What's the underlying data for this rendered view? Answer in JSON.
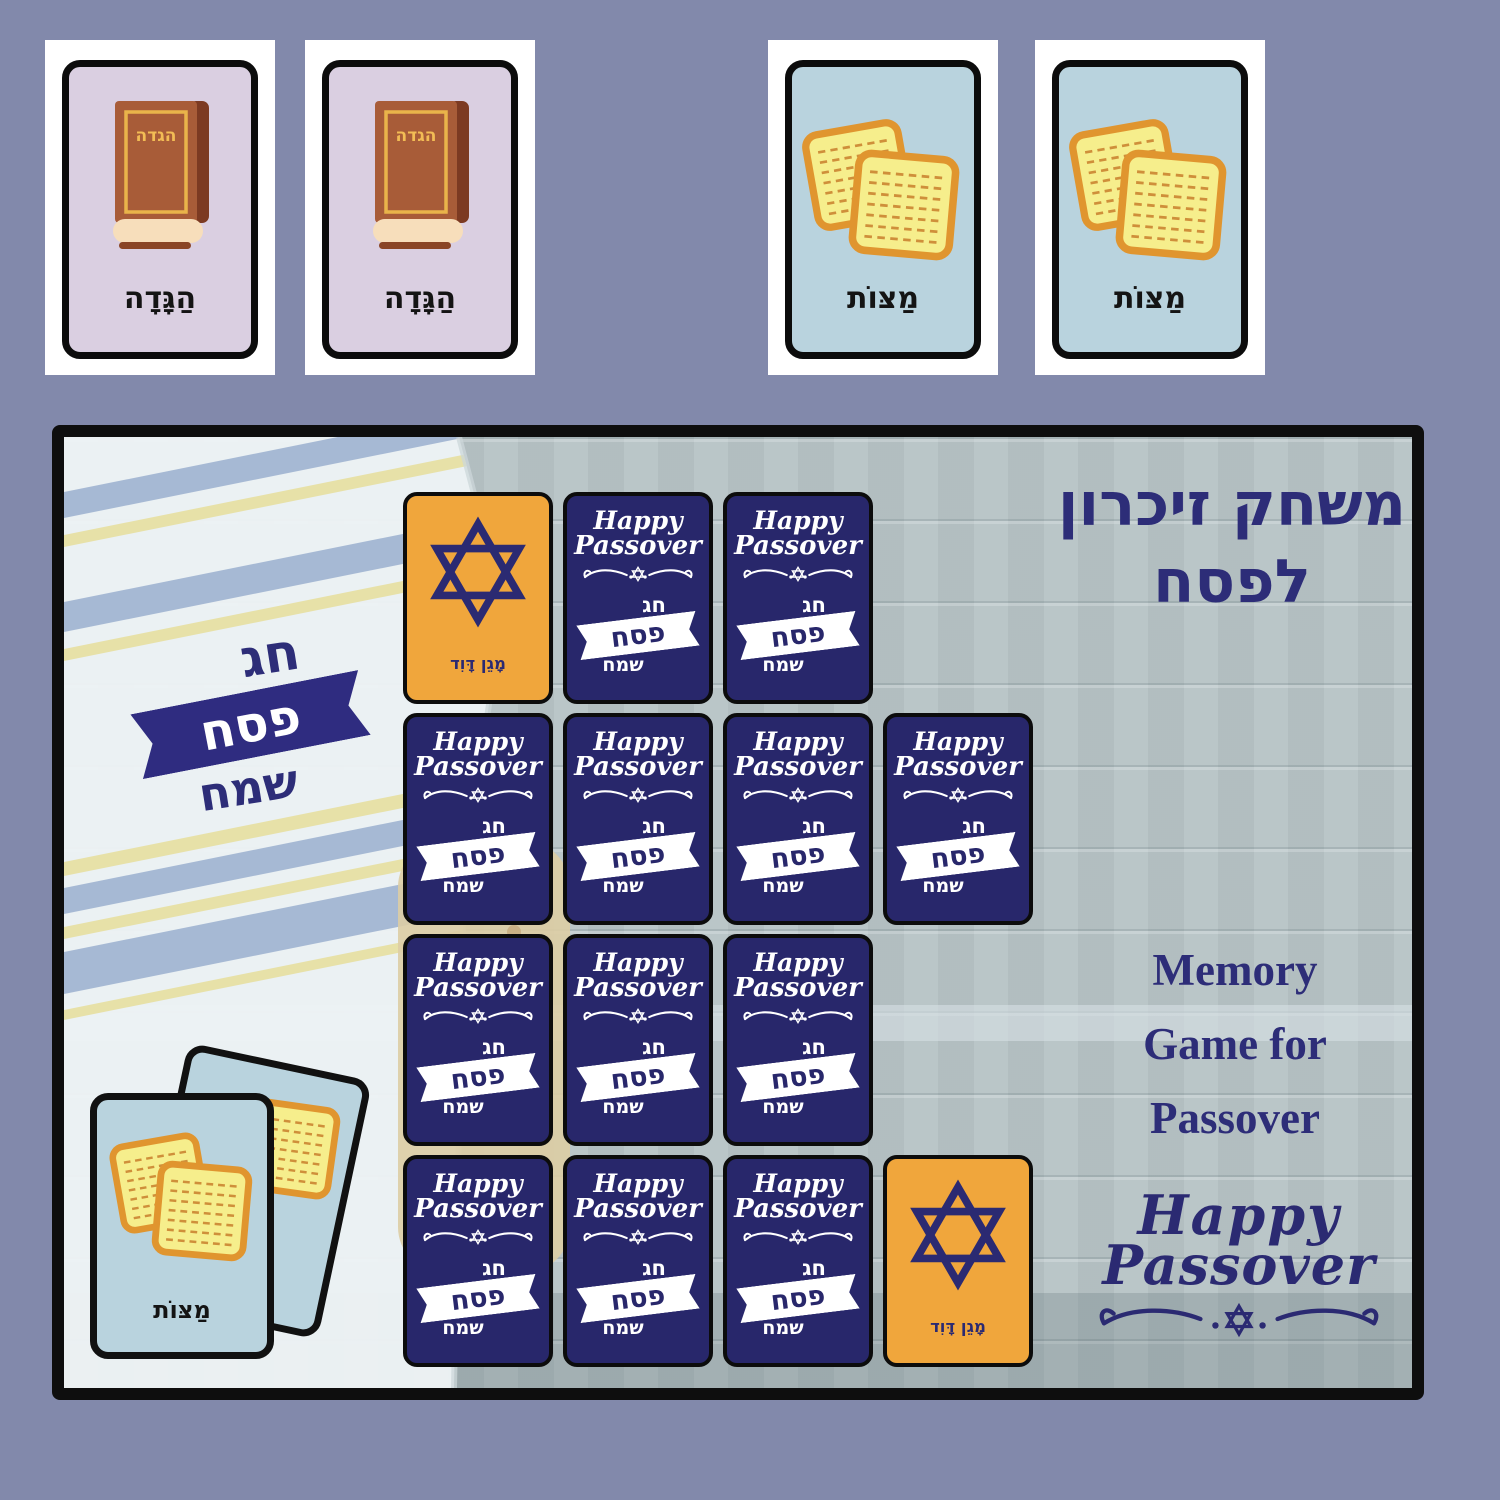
{
  "colors": {
    "page_bg": "#8289ab",
    "navy": "#2d2d78",
    "card_navy": "#28276b",
    "orange": "#f0a63c",
    "light_blue": "#b9d3de",
    "lavender": "#dacfe1",
    "wood": "#b6c2c5",
    "matzah_fill": "#f6ee8c",
    "matzah_border": "#e0952f",
    "black": "#0e0e0e"
  },
  "top_cards": [
    {
      "type": "haggadah",
      "label": "הַגָּדָה",
      "book_title": "הגדה"
    },
    {
      "type": "haggadah",
      "label": "הַגָּדָה",
      "book_title": "הגדה"
    },
    {
      "type": "matzot",
      "label": "מַצּוֹת"
    },
    {
      "type": "matzot",
      "label": "מַצּוֹת"
    }
  ],
  "board": {
    "title": {
      "line1": "משחק זיכרון",
      "line2": "לפסח"
    },
    "badge": {
      "top": "חג",
      "middle": "פסח",
      "bottom": "שמח"
    },
    "memory_lines": [
      "Memory",
      "Game for",
      "Passover"
    ],
    "logo": {
      "line1": "Happy",
      "line2": "Passover"
    },
    "card_back": {
      "line1": "Happy",
      "line2": "Passover",
      "heb_top": "חג",
      "heb_middle": "פסח",
      "heb_bottom": "שמח"
    },
    "star_card": {
      "label": "מָגֵן דָּוִד"
    },
    "stack_card": {
      "label": "מַצּוֹת"
    },
    "grid": [
      "star",
      "back",
      "back",
      "empty",
      "back",
      "back",
      "back",
      "back",
      "back",
      "back",
      "back",
      "empty",
      "back",
      "back",
      "back",
      "star"
    ]
  }
}
